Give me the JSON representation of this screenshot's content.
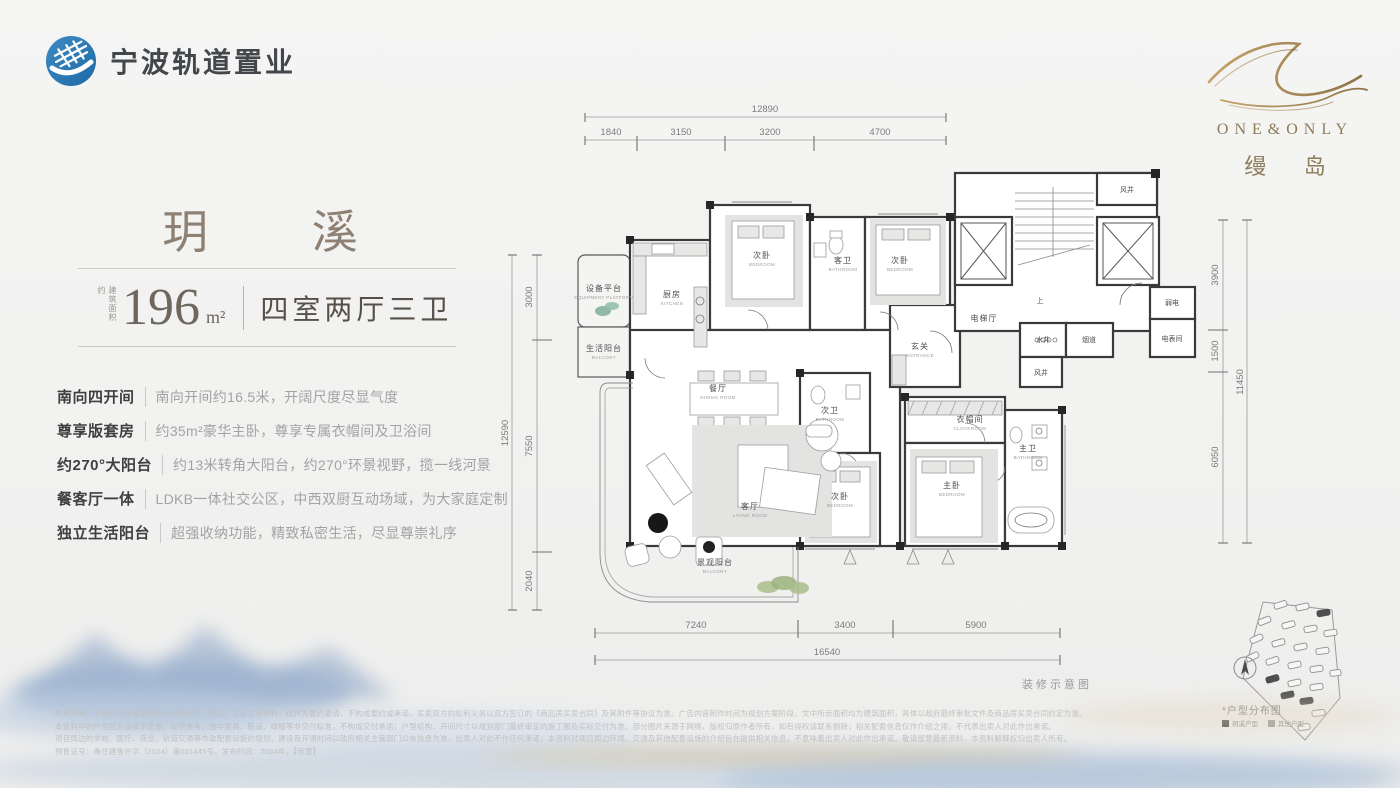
{
  "brand": {
    "name": "宁波轨道置业"
  },
  "project": {
    "en": "ONE&ONLY",
    "cn": "缦 岛"
  },
  "unit": {
    "name": "玥 溪",
    "area_prefix": "建筑面积约",
    "area_value": "196",
    "area_unit": "m²",
    "layout": "四室两厅三卫",
    "features": [
      {
        "label": "南向四开间",
        "desc": "南向开间约16.5米，开阔尺度尽显气度"
      },
      {
        "label": "尊享版套房",
        "desc": "约35m²豪华主卧，尊享专属衣帽间及卫浴间"
      },
      {
        "label": "约270°大阳台",
        "desc": "约13米转角大阳台，约270°环景视野，揽一线河景"
      },
      {
        "label": "餐客厅一体",
        "desc": "LDKB一体社交公区，中西双厨互动场域，为大家庭定制"
      },
      {
        "label": "独立生活阳台",
        "desc": "超强收纳功能，精致私密生活，尽显尊崇礼序"
      }
    ]
  },
  "plan": {
    "caption": "装修示意图",
    "stair_up_label": "上",
    "rooms": [
      {
        "cn": "设备平台",
        "en": "EQUIPMENT PLATFORM"
      },
      {
        "cn": "生活阳台",
        "en": "BALCONY"
      },
      {
        "cn": "厨房",
        "en": "KITCHEN"
      },
      {
        "cn": "次卧",
        "en": "BEDROOM"
      },
      {
        "cn": "客卫",
        "en": "BATHROOM"
      },
      {
        "cn": "次卧",
        "en": "BEDROOM"
      },
      {
        "cn": "玄关",
        "en": "ENTRANCE"
      },
      {
        "cn": "电梯厅",
        "en": ""
      },
      {
        "cn": "水井",
        "en": ""
      },
      {
        "cn": "烟道",
        "en": ""
      },
      {
        "cn": "风井",
        "en": ""
      },
      {
        "cn": "弱电",
        "en": ""
      },
      {
        "cn": "电表间",
        "en": ""
      },
      {
        "cn": "风井",
        "en": ""
      },
      {
        "cn": "餐厅",
        "en": "DINING ROOM"
      },
      {
        "cn": "客厅",
        "en": "LIVING ROOM"
      },
      {
        "cn": "次卫",
        "en": "BATHROOM"
      },
      {
        "cn": "次卧",
        "en": "BEDROOM"
      },
      {
        "cn": "衣帽间",
        "en": "CLOAKROOM"
      },
      {
        "cn": "主卧",
        "en": "BEDROOM"
      },
      {
        "cn": "主卫",
        "en": "BATHROOM"
      },
      {
        "cn": "景观阳台",
        "en": "BALCONY"
      }
    ],
    "dims": {
      "top": {
        "total": "12890",
        "segments": [
          "1840",
          "3150",
          "3200",
          "4700"
        ]
      },
      "left": {
        "total": "12590",
        "segments": [
          "3000",
          "7550",
          "2040"
        ]
      },
      "right": {
        "total": "11450",
        "segments": [
          "3900",
          "1500",
          "6050"
        ]
      },
      "bottom": {
        "total": "16540",
        "segments": [
          "7240",
          "3400",
          "5900"
        ]
      }
    }
  },
  "siteplan": {
    "title": "*户型分布图",
    "legend": [
      {
        "label": "玥溪户型",
        "color": "#4a4a4a"
      },
      {
        "label": "其他户型",
        "color": "#9a9a9a"
      }
    ]
  },
  "disclaimer": {
    "lines": [
      "免责声明：本资料为宁波轨道置业有限公司「缦岛」项目宣传资料，仅作为要约邀请，不构成要约或承诺，买卖双方的权利义务以双方签订的《商品房买卖合同》及其附件等协议为准。广告内容制作时间为规划方案阶段，文中所示面积均为建筑面积，具体以政府最终审批文件及商品房买卖合同约定为准。",
      "本资料中的户型图为装修示意图，仅供参考，图中家具、陈设、绿植等非交付标准，不构成交付承诺；户型结构、开间尺寸以规划部门最终审定的施工图及实际交付为准。部分图片来源于网络，版权归原作者所有，如有侵权请联系删除；相关配套信息仅作介绍之用，不代表出卖人对此作出承诺。",
      "项目周边的学校、医疗、商业、轨道交通等市政配套设施的规划、建设及开通时间以政府相关主管部门公布信息为准，出卖人对此不作任何承诺；本资料对项目周边环境、交通及其他配套设施的介绍旨在提供相关信息，不意味着出卖人对此作出承诺。敬请留意最新资料，本资料解释权归出卖人所有。",
      "预售证号：甬住建售许字（2024）第001445号。发布时间：2024年。【示意】"
    ]
  }
}
